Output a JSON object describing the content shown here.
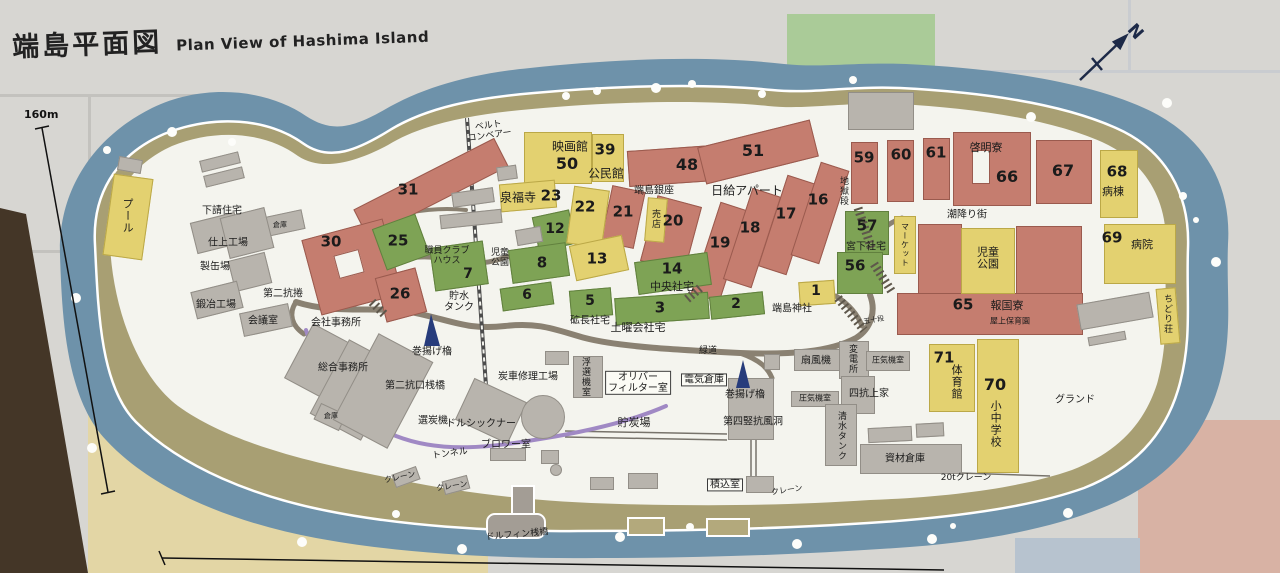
{
  "title": {
    "ja": "端島平面図",
    "en": "Plan View of Hashima Island"
  },
  "compass": {
    "label": "N"
  },
  "scale": {
    "vertical_label": "160m"
  },
  "palette": {
    "sea": "#6e92aa",
    "seawall": "#a89f73",
    "island_ground": "#f4f4ee",
    "apartment_red": "#c57d6f",
    "housing_green": "#7ea355",
    "public_yellow": "#e3d170",
    "industrial_gray": "#b8b4ad",
    "road": "#8a8172",
    "tunnel_purple": "#a089c4",
    "tower_navy": "#273c7c"
  },
  "buildings": [
    {
      "c": "red",
      "x": 352,
      "y": 172,
      "w": 158,
      "h": 32,
      "r": -27
    },
    {
      "c": "red",
      "x": 310,
      "y": 228,
      "w": 84,
      "h": 78,
      "r": -15
    },
    {
      "c": "inner",
      "x": 336,
      "y": 252,
      "w": 26,
      "h": 24,
      "r": -15
    },
    {
      "c": "red",
      "x": 380,
      "y": 272,
      "w": 42,
      "h": 46,
      "r": -15
    },
    {
      "c": "red",
      "x": 628,
      "y": 148,
      "w": 86,
      "h": 36,
      "r": -4
    },
    {
      "c": "red",
      "x": 700,
      "y": 133,
      "w": 116,
      "h": 38,
      "r": -14
    },
    {
      "c": "red",
      "x": 606,
      "y": 188,
      "w": 34,
      "h": 58,
      "r": 12
    },
    {
      "c": "red",
      "x": 648,
      "y": 200,
      "w": 46,
      "h": 68,
      "r": 15
    },
    {
      "c": "red",
      "x": 705,
      "y": 204,
      "w": 30,
      "h": 96,
      "r": 18
    },
    {
      "c": "red",
      "x": 737,
      "y": 190,
      "w": 30,
      "h": 96,
      "r": 18
    },
    {
      "c": "red",
      "x": 772,
      "y": 177,
      "w": 30,
      "h": 96,
      "r": 18
    },
    {
      "c": "red",
      "x": 805,
      "y": 164,
      "w": 30,
      "h": 98,
      "r": 18
    },
    {
      "c": "red",
      "x": 851,
      "y": 142,
      "w": 27,
      "h": 62,
      "r": 0
    },
    {
      "c": "red",
      "x": 887,
      "y": 140,
      "w": 27,
      "h": 62,
      "r": 0
    },
    {
      "c": "red",
      "x": 923,
      "y": 138,
      "w": 27,
      "h": 62,
      "r": 0
    },
    {
      "c": "red",
      "x": 953,
      "y": 132,
      "w": 78,
      "h": 74,
      "r": 0
    },
    {
      "c": "inner",
      "x": 972,
      "y": 150,
      "w": 18,
      "h": 34,
      "r": 0
    },
    {
      "c": "red",
      "x": 1036,
      "y": 140,
      "w": 56,
      "h": 64,
      "r": 0
    },
    {
      "c": "red",
      "x": 897,
      "y": 293,
      "w": 186,
      "h": 42,
      "r": 0
    },
    {
      "c": "red",
      "x": 918,
      "y": 224,
      "w": 44,
      "h": 70,
      "r": 0
    },
    {
      "c": "red",
      "x": 1016,
      "y": 226,
      "w": 66,
      "h": 68,
      "r": 0
    },
    {
      "c": "green",
      "x": 378,
      "y": 220,
      "w": 46,
      "h": 44,
      "r": -20
    },
    {
      "c": "green",
      "x": 432,
      "y": 244,
      "w": 54,
      "h": 44,
      "r": -8
    },
    {
      "c": "green",
      "x": 535,
      "y": 213,
      "w": 38,
      "h": 35,
      "r": -12
    },
    {
      "c": "green",
      "x": 510,
      "y": 246,
      "w": 58,
      "h": 34,
      "r": -8
    },
    {
      "c": "green",
      "x": 501,
      "y": 285,
      "w": 52,
      "h": 23,
      "r": -8
    },
    {
      "c": "green",
      "x": 570,
      "y": 289,
      "w": 42,
      "h": 28,
      "r": -5
    },
    {
      "c": "green",
      "x": 615,
      "y": 295,
      "w": 94,
      "h": 27,
      "r": -4
    },
    {
      "c": "green",
      "x": 710,
      "y": 294,
      "w": 54,
      "h": 23,
      "r": -6
    },
    {
      "c": "green",
      "x": 636,
      "y": 257,
      "w": 74,
      "h": 33,
      "r": -8
    },
    {
      "c": "green",
      "x": 845,
      "y": 211,
      "w": 44,
      "h": 44,
      "r": 0
    },
    {
      "c": "green",
      "x": 837,
      "y": 252,
      "w": 46,
      "h": 42,
      "r": 0
    },
    {
      "c": "yellow",
      "x": 108,
      "y": 176,
      "w": 40,
      "h": 82,
      "r": 8
    },
    {
      "c": "yellow",
      "x": 524,
      "y": 132,
      "w": 68,
      "h": 52,
      "r": 0
    },
    {
      "c": "yellow",
      "x": 592,
      "y": 134,
      "w": 32,
      "h": 48,
      "r": 0
    },
    {
      "c": "yellow",
      "x": 500,
      "y": 182,
      "w": 56,
      "h": 28,
      "r": -5
    },
    {
      "c": "yellow",
      "x": 570,
      "y": 188,
      "w": 36,
      "h": 58,
      "r": 8
    },
    {
      "c": "yellow",
      "x": 572,
      "y": 240,
      "w": 54,
      "h": 36,
      "r": -12
    },
    {
      "c": "yellow",
      "x": 646,
      "y": 198,
      "w": 20,
      "h": 44,
      "r": 5
    },
    {
      "c": "yellow",
      "x": 799,
      "y": 281,
      "w": 36,
      "h": 24,
      "r": -4
    },
    {
      "c": "yellow",
      "x": 894,
      "y": 216,
      "w": 22,
      "h": 58,
      "r": 0
    },
    {
      "c": "yellow",
      "x": 961,
      "y": 228,
      "w": 54,
      "h": 66,
      "r": 0
    },
    {
      "c": "yellow",
      "x": 1100,
      "y": 150,
      "w": 38,
      "h": 68,
      "r": 0
    },
    {
      "c": "yellow",
      "x": 1104,
      "y": 224,
      "w": 72,
      "h": 60,
      "r": 0
    },
    {
      "c": "yellow",
      "x": 1158,
      "y": 288,
      "w": 20,
      "h": 56,
      "r": -5
    },
    {
      "c": "yellow",
      "x": 929,
      "y": 344,
      "w": 46,
      "h": 68,
      "r": 0
    },
    {
      "c": "yellow",
      "x": 977,
      "y": 339,
      "w": 42,
      "h": 134,
      "r": 0
    },
    {
      "c": "gray",
      "x": 200,
      "y": 156,
      "w": 40,
      "h": 12,
      "r": -14
    },
    {
      "c": "gray",
      "x": 204,
      "y": 171,
      "w": 40,
      "h": 12,
      "r": -14
    },
    {
      "c": "gray",
      "x": 118,
      "y": 158,
      "w": 24,
      "h": 14,
      "r": 10
    },
    {
      "c": "gray",
      "x": 193,
      "y": 217,
      "w": 46,
      "h": 32,
      "r": -14
    },
    {
      "c": "gray",
      "x": 256,
      "y": 214,
      "w": 48,
      "h": 20,
      "r": -12
    },
    {
      "c": "gray",
      "x": 224,
      "y": 212,
      "w": 46,
      "h": 42,
      "r": -14
    },
    {
      "c": "gray",
      "x": 231,
      "y": 256,
      "w": 38,
      "h": 32,
      "r": -14
    },
    {
      "c": "gray",
      "x": 193,
      "y": 286,
      "w": 48,
      "h": 28,
      "r": -14
    },
    {
      "c": "gray",
      "x": 241,
      "y": 308,
      "w": 50,
      "h": 24,
      "r": -12
    },
    {
      "c": "gray",
      "x": 296,
      "y": 330,
      "w": 44,
      "h": 62,
      "r": 28
    },
    {
      "c": "gray",
      "x": 326,
      "y": 348,
      "w": 58,
      "h": 84,
      "r": 28
    },
    {
      "c": "gray",
      "x": 316,
      "y": 408,
      "w": 28,
      "h": 18,
      "r": 25
    },
    {
      "c": "gray",
      "x": 352,
      "y": 342,
      "w": 62,
      "h": 98,
      "r": 28
    },
    {
      "c": "gray",
      "x": 462,
      "y": 388,
      "w": 58,
      "h": 46,
      "r": 25
    },
    {
      "c": "gray",
      "x": 440,
      "y": 212,
      "w": 62,
      "h": 14,
      "r": -6
    },
    {
      "c": "gray",
      "x": 452,
      "y": 190,
      "w": 42,
      "h": 15,
      "r": -8
    },
    {
      "c": "gray",
      "x": 497,
      "y": 166,
      "w": 20,
      "h": 14,
      "r": -8
    },
    {
      "c": "gray",
      "x": 516,
      "y": 228,
      "w": 26,
      "h": 16,
      "r": -10
    },
    {
      "c": "gray",
      "x": 545,
      "y": 351,
      "w": 24,
      "h": 14,
      "r": 0
    },
    {
      "c": "gray",
      "x": 764,
      "y": 354,
      "w": 16,
      "h": 16,
      "r": 0
    },
    {
      "c": "gray",
      "x": 490,
      "y": 448,
      "w": 36,
      "h": 13,
      "r": 0
    },
    {
      "c": "gray",
      "x": 573,
      "y": 356,
      "w": 30,
      "h": 42,
      "r": 0
    },
    {
      "c": "gray",
      "x": 728,
      "y": 378,
      "w": 46,
      "h": 62,
      "r": 0
    },
    {
      "c": "gray",
      "x": 746,
      "y": 476,
      "w": 28,
      "h": 17,
      "r": 0
    },
    {
      "c": "gray",
      "x": 794,
      "y": 349,
      "w": 46,
      "h": 22,
      "r": 0
    },
    {
      "c": "gray",
      "x": 839,
      "y": 341,
      "w": 30,
      "h": 38,
      "r": 0
    },
    {
      "c": "gray",
      "x": 866,
      "y": 351,
      "w": 44,
      "h": 20,
      "r": 0
    },
    {
      "c": "gray",
      "x": 791,
      "y": 391,
      "w": 48,
      "h": 16,
      "r": 0
    },
    {
      "c": "gray",
      "x": 841,
      "y": 376,
      "w": 34,
      "h": 38,
      "r": 0
    },
    {
      "c": "gray",
      "x": 825,
      "y": 404,
      "w": 32,
      "h": 62,
      "r": 0
    },
    {
      "c": "gray",
      "x": 860,
      "y": 444,
      "w": 102,
      "h": 30,
      "r": 0
    },
    {
      "c": "gray",
      "x": 868,
      "y": 427,
      "w": 44,
      "h": 15,
      "r": -3
    },
    {
      "c": "gray",
      "x": 916,
      "y": 423,
      "w": 28,
      "h": 14,
      "r": -3
    },
    {
      "c": "gray",
      "x": 1078,
      "y": 298,
      "w": 74,
      "h": 26,
      "r": -10
    },
    {
      "c": "gray",
      "x": 1088,
      "y": 334,
      "w": 38,
      "h": 9,
      "r": -10
    },
    {
      "c": "gray",
      "x": 393,
      "y": 470,
      "w": 26,
      "h": 14,
      "r": -20
    },
    {
      "c": "gray",
      "x": 443,
      "y": 478,
      "w": 26,
      "h": 14,
      "r": -15
    },
    {
      "c": "gray",
      "x": 541,
      "y": 450,
      "w": 18,
      "h": 14,
      "r": 0
    },
    {
      "c": "gray",
      "x": 590,
      "y": 477,
      "w": 24,
      "h": 13,
      "r": 0
    },
    {
      "c": "gray",
      "x": 628,
      "y": 473,
      "w": 30,
      "h": 16,
      "r": 0
    },
    {
      "c": "gray",
      "x": 848,
      "y": 92,
      "w": 66,
      "h": 38,
      "r": 0
    },
    {
      "c": "gray circle",
      "x": 521,
      "y": 395,
      "w": 44,
      "h": 44,
      "r": 0
    },
    {
      "c": "gray circle",
      "x": 550,
      "y": 464,
      "w": 12,
      "h": 12,
      "r": 0
    }
  ],
  "labels": [
    {
      "t": "31",
      "x": 408,
      "y": 190,
      "s": 15,
      "b": 1
    },
    {
      "t": "30",
      "x": 331,
      "y": 242,
      "s": 15,
      "b": 1
    },
    {
      "t": "26",
      "x": 400,
      "y": 294,
      "s": 15,
      "b": 1
    },
    {
      "t": "25",
      "x": 398,
      "y": 241,
      "s": 15,
      "b": 1
    },
    {
      "t": "7",
      "x": 468,
      "y": 275,
      "s": 14,
      "b": 1
    },
    {
      "t": "12",
      "x": 555,
      "y": 230,
      "s": 14,
      "b": 1
    },
    {
      "t": "8",
      "x": 542,
      "y": 263,
      "s": 15,
      "b": 1
    },
    {
      "t": "6",
      "x": 527,
      "y": 296,
      "s": 14,
      "b": 1
    },
    {
      "t": "5",
      "x": 590,
      "y": 302,
      "s": 14,
      "b": 1
    },
    {
      "t": "3",
      "x": 660,
      "y": 308,
      "s": 15,
      "b": 1
    },
    {
      "t": "2",
      "x": 736,
      "y": 305,
      "s": 14,
      "b": 1
    },
    {
      "t": "14",
      "x": 672,
      "y": 269,
      "s": 15,
      "b": 1
    },
    {
      "t": "13",
      "x": 597,
      "y": 259,
      "s": 15,
      "b": 1
    },
    {
      "t": "23",
      "x": 551,
      "y": 196,
      "s": 15,
      "b": 1
    },
    {
      "t": "22",
      "x": 585,
      "y": 207,
      "s": 15,
      "b": 1
    },
    {
      "t": "21",
      "x": 623,
      "y": 212,
      "s": 15,
      "b": 1
    },
    {
      "t": "20",
      "x": 673,
      "y": 221,
      "s": 15,
      "b": 1
    },
    {
      "t": "50",
      "x": 567,
      "y": 164,
      "s": 16,
      "b": 1
    },
    {
      "t": "39",
      "x": 605,
      "y": 150,
      "s": 15,
      "b": 1
    },
    {
      "t": "48",
      "x": 687,
      "y": 165,
      "s": 16,
      "b": 1
    },
    {
      "t": "51",
      "x": 753,
      "y": 151,
      "s": 16,
      "b": 1
    },
    {
      "t": "19",
      "x": 720,
      "y": 243,
      "s": 15,
      "b": 1
    },
    {
      "t": "18",
      "x": 750,
      "y": 228,
      "s": 15,
      "b": 1
    },
    {
      "t": "17",
      "x": 786,
      "y": 214,
      "s": 15,
      "b": 1
    },
    {
      "t": "16",
      "x": 818,
      "y": 200,
      "s": 15,
      "b": 1
    },
    {
      "t": "59",
      "x": 864,
      "y": 158,
      "s": 15,
      "b": 1
    },
    {
      "t": "60",
      "x": 901,
      "y": 155,
      "s": 15,
      "b": 1
    },
    {
      "t": "61",
      "x": 936,
      "y": 153,
      "s": 15,
      "b": 1
    },
    {
      "t": "66",
      "x": 1007,
      "y": 177,
      "s": 16,
      "b": 1
    },
    {
      "t": "67",
      "x": 1063,
      "y": 171,
      "s": 16,
      "b": 1
    },
    {
      "t": "68",
      "x": 1117,
      "y": 172,
      "s": 15,
      "b": 1
    },
    {
      "t": "69",
      "x": 1112,
      "y": 238,
      "s": 15,
      "b": 1
    },
    {
      "t": "65",
      "x": 963,
      "y": 305,
      "s": 15,
      "b": 1
    },
    {
      "t": "57",
      "x": 867,
      "y": 226,
      "s": 15,
      "b": 1
    },
    {
      "t": "56",
      "x": 855,
      "y": 266,
      "s": 15,
      "b": 1
    },
    {
      "t": "1",
      "x": 816,
      "y": 292,
      "s": 14,
      "b": 1
    },
    {
      "t": "71",
      "x": 944,
      "y": 358,
      "s": 15,
      "b": 1
    },
    {
      "t": "70",
      "x": 995,
      "y": 385,
      "s": 16,
      "b": 1
    },
    {
      "t": "プール",
      "x": 127,
      "y": 216,
      "s": 11,
      "v": 1
    },
    {
      "t": "下請住宅",
      "x": 222,
      "y": 211,
      "s": 10
    },
    {
      "t": "倉庫",
      "x": 280,
      "y": 226,
      "s": 7
    },
    {
      "t": "仕上工場",
      "x": 228,
      "y": 243,
      "s": 10
    },
    {
      "t": "製缶場",
      "x": 215,
      "y": 267,
      "s": 10
    },
    {
      "t": "鍛冶工場",
      "x": 216,
      "y": 305,
      "s": 10
    },
    {
      "t": "会議室",
      "x": 263,
      "y": 321,
      "s": 10
    },
    {
      "t": "第二抗捲",
      "x": 283,
      "y": 294,
      "s": 10
    },
    {
      "t": "会社事務所",
      "x": 336,
      "y": 323,
      "s": 10
    },
    {
      "t": "総合事務所",
      "x": 343,
      "y": 368,
      "s": 10
    },
    {
      "t": "倉庫",
      "x": 331,
      "y": 417,
      "s": 7
    },
    {
      "t": "第二抗口桟橋",
      "x": 415,
      "y": 386,
      "s": 10
    },
    {
      "t": "巻揚げ櫓",
      "x": 432,
      "y": 352,
      "s": 10
    },
    {
      "t": "選炭機",
      "x": 433,
      "y": 421,
      "s": 10
    },
    {
      "t": "トンネル",
      "x": 450,
      "y": 454,
      "s": 9,
      "r": -8
    },
    {
      "t": "クレーン",
      "x": 400,
      "y": 478,
      "s": 8,
      "r": -12
    },
    {
      "t": "クレーン",
      "x": 452,
      "y": 487,
      "s": 8,
      "r": -8
    },
    {
      "t": "ドルシックナー",
      "x": 481,
      "y": 424,
      "s": 10
    },
    {
      "t": "ブロワー室",
      "x": 506,
      "y": 445,
      "s": 10
    },
    {
      "t": "炭車修理工場",
      "x": 528,
      "y": 377,
      "s": 10
    },
    {
      "t": "浮選機室",
      "x": 585,
      "y": 377,
      "s": 9,
      "v": 1
    },
    {
      "t": "オリバー\nフィルター室",
      "x": 638,
      "y": 383,
      "s": 10,
      "bg": 1
    },
    {
      "t": "電気倉庫",
      "x": 704,
      "y": 380,
      "s": 10,
      "bg": 1
    },
    {
      "t": "巻揚げ櫓",
      "x": 745,
      "y": 395,
      "s": 10
    },
    {
      "t": "第四竪抗風洞",
      "x": 753,
      "y": 422,
      "s": 10
    },
    {
      "t": "貯炭場",
      "x": 634,
      "y": 423,
      "s": 11
    },
    {
      "t": "積込室",
      "x": 725,
      "y": 485,
      "s": 10,
      "bg": 1
    },
    {
      "t": "クレーン",
      "x": 787,
      "y": 491,
      "s": 8,
      "r": -8
    },
    {
      "t": "緑道",
      "x": 708,
      "y": 351,
      "s": 9
    },
    {
      "t": "扇風機",
      "x": 816,
      "y": 361,
      "s": 10
    },
    {
      "t": "変電所",
      "x": 852,
      "y": 359,
      "s": 9,
      "v": 1
    },
    {
      "t": "圧気機室",
      "x": 888,
      "y": 361,
      "s": 8
    },
    {
      "t": "四抗上家",
      "x": 869,
      "y": 394,
      "s": 10
    },
    {
      "t": "圧気機室",
      "x": 815,
      "y": 399,
      "s": 8
    },
    {
      "t": "清水タンク",
      "x": 841,
      "y": 436,
      "s": 9,
      "v": 1
    },
    {
      "t": "資材倉庫",
      "x": 905,
      "y": 459,
      "s": 10
    },
    {
      "t": "20tクレーン",
      "x": 966,
      "y": 478,
      "s": 9
    },
    {
      "t": "ドルフィン桟橋",
      "x": 517,
      "y": 535,
      "s": 9,
      "r": -5
    },
    {
      "t": "ベルト\nコンベアー",
      "x": 489,
      "y": 131,
      "s": 9,
      "r": -8
    },
    {
      "t": "映画館",
      "x": 570,
      "y": 147,
      "s": 12
    },
    {
      "t": "公民館",
      "x": 606,
      "y": 174,
      "s": 12
    },
    {
      "t": "泉福寺",
      "x": 518,
      "y": 198,
      "s": 12
    },
    {
      "t": "端島銀座",
      "x": 654,
      "y": 191,
      "s": 10
    },
    {
      "t": "売店",
      "x": 655,
      "y": 219,
      "s": 9,
      "v": 1
    },
    {
      "t": "日給アパート",
      "x": 747,
      "y": 191,
      "s": 12
    },
    {
      "t": "地獄段",
      "x": 843,
      "y": 191,
      "s": 9,
      "v": 1
    },
    {
      "t": "啓明寮",
      "x": 986,
      "y": 148,
      "s": 11
    },
    {
      "t": "潮降り街",
      "x": 967,
      "y": 215,
      "s": 10
    },
    {
      "t": "マーケット",
      "x": 904,
      "y": 245,
      "s": 8,
      "v": 1
    },
    {
      "t": "児童\n公園",
      "x": 988,
      "y": 259,
      "s": 11
    },
    {
      "t": "児童\n公園",
      "x": 500,
      "y": 258,
      "s": 9
    },
    {
      "t": "職員クラブ\nハウス",
      "x": 447,
      "y": 256,
      "s": 9
    },
    {
      "t": "貯水\nタンク",
      "x": 459,
      "y": 302,
      "s": 10
    },
    {
      "t": "宮下社宅",
      "x": 866,
      "y": 247,
      "s": 10
    },
    {
      "t": "中央社宅",
      "x": 672,
      "y": 287,
      "s": 11
    },
    {
      "t": "砿長社宅",
      "x": 590,
      "y": 321,
      "s": 10
    },
    {
      "t": "土曜会社宅",
      "x": 638,
      "y": 328,
      "s": 11
    },
    {
      "t": "端島神社",
      "x": 792,
      "y": 309,
      "s": 10
    },
    {
      "t": "報国寮",
      "x": 1007,
      "y": 306,
      "s": 11
    },
    {
      "t": "屋上保育園",
      "x": 1010,
      "y": 322,
      "s": 8
    },
    {
      "t": "病棟",
      "x": 1113,
      "y": 192,
      "s": 11
    },
    {
      "t": "病院",
      "x": 1142,
      "y": 245,
      "s": 11
    },
    {
      "t": "ちどり荘",
      "x": 1167,
      "y": 314,
      "s": 9,
      "v": 1
    },
    {
      "t": "体育館",
      "x": 956,
      "y": 382,
      "s": 11,
      "v": 1
    },
    {
      "t": "小中学校",
      "x": 995,
      "y": 424,
      "s": 11,
      "v": 1
    },
    {
      "t": "グランド",
      "x": 1075,
      "y": 400,
      "s": 10
    },
    {
      "t": "五十段",
      "x": 874,
      "y": 321,
      "s": 7,
      "r": -10
    }
  ]
}
